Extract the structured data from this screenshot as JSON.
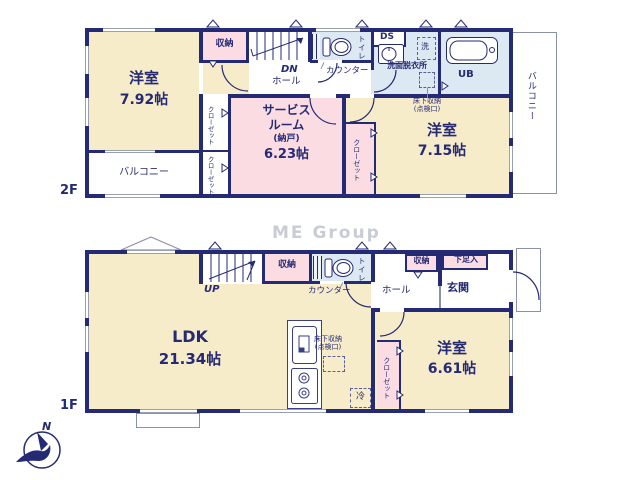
{
  "watermark": "ME Group",
  "compass": {
    "label": "N"
  },
  "f2": {
    "floor_label": "2F",
    "bedroom1": {
      "name": "洋室",
      "size": "7.92帖"
    },
    "storage": "収納",
    "stairs_dn": "DN",
    "hall": "ホール",
    "toilet": "トイレ",
    "counter": "カウンター",
    "ds": "DS",
    "washer": "洗",
    "washroom": "洗面脱衣所",
    "unit_bath": "UB",
    "underfloor_storage": {
      "line1": "床下収納",
      "line2": "(点検口)"
    },
    "closet_a": "クローゼット",
    "closet_b": "クローゼット",
    "closet_c": "クローゼット",
    "service_room": {
      "line1": "サービス",
      "line2": "ルーム",
      "line3": "(納戸)",
      "size": "6.23帖"
    },
    "bedroom2": {
      "name": "洋室",
      "size": "7.15帖"
    },
    "balcony_left": "バルコニー",
    "balcony_right": "バルコニー"
  },
  "f1": {
    "floor_label": "1F",
    "stairs_up": "UP",
    "storage": "収納",
    "toilet": "トイレ",
    "counter": "カウンター",
    "hall": "ホール",
    "hall_storage": "収納",
    "shoe_box": "下足入",
    "entrance": "玄関",
    "ldk": {
      "name": "LDK",
      "size": "21.34帖"
    },
    "underfloor_storage": {
      "line1": "床下収納",
      "line2": "(点検口)"
    },
    "fridge": "冷",
    "closet": "クローゼット",
    "bedroom3": {
      "name": "洋室",
      "size": "6.61帖"
    }
  }
}
